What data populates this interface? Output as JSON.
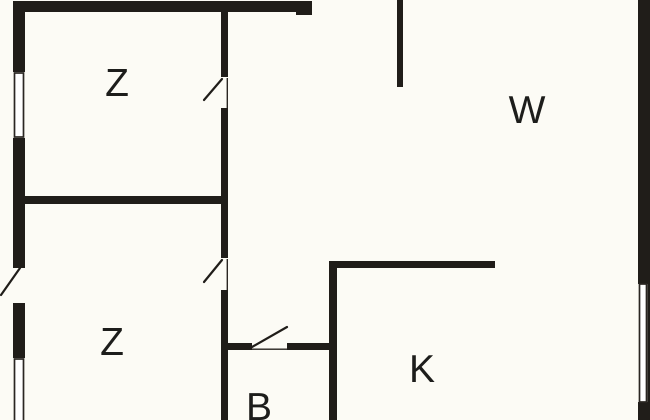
{
  "title": "Floor plan",
  "canvas": {
    "width": 650,
    "height": 420,
    "background": "#fcfbf5",
    "wall_color": "#201d19",
    "line_color": "#2a2622",
    "window_fill": "#ffffff",
    "label_color": "#1d1d1b"
  },
  "rooms": [
    {
      "label": "Z",
      "x": 117,
      "y": 96
    },
    {
      "label": "Z",
      "x": 112,
      "y": 355
    },
    {
      "label": "W",
      "x": 527,
      "y": 123
    },
    {
      "label": "K",
      "x": 422,
      "y": 382
    },
    {
      "label": "B",
      "x": 259,
      "y": 420
    }
  ],
  "plan": {
    "walls": [
      {
        "x": 13,
        "y": 1,
        "w": 299,
        "h": 11
      },
      {
        "x": 296,
        "y": 11,
        "w": 16,
        "h": 4
      },
      {
        "x": 13,
        "y": 1,
        "w": 12,
        "h": 71
      },
      {
        "x": 13,
        "y": 138,
        "w": 12,
        "h": 130
      },
      {
        "x": 13,
        "y": 303,
        "w": 12,
        "h": 55
      },
      {
        "x": 13,
        "y": 196,
        "w": 215,
        "h": 8
      },
      {
        "x": 221,
        "y": 11,
        "w": 7,
        "h": 66
      },
      {
        "x": 221,
        "y": 108,
        "w": 7,
        "h": 150
      },
      {
        "x": 221,
        "y": 290,
        "w": 7,
        "h": 130
      },
      {
        "x": 397,
        "y": 0,
        "w": 6,
        "h": 87
      },
      {
        "x": 638,
        "y": 0,
        "w": 12,
        "h": 284
      },
      {
        "x": 638,
        "y": 402,
        "w": 12,
        "h": 18
      },
      {
        "x": 329,
        "y": 261,
        "w": 166,
        "h": 7
      },
      {
        "x": 329,
        "y": 261,
        "w": 8,
        "h": 159
      },
      {
        "x": 228,
        "y": 343,
        "w": 24,
        "h": 7
      },
      {
        "x": 287,
        "y": 343,
        "w": 42,
        "h": 7
      },
      {
        "x": 647.5,
        "y": 284,
        "w": 2.5,
        "h": 118
      }
    ],
    "windows": [
      {
        "x": 14.5,
        "y": 73,
        "w": 9,
        "h": 64
      },
      {
        "x": 14.5,
        "y": 359,
        "w": 9,
        "h": 63
      },
      {
        "x": 639.5,
        "y": 284,
        "w": 7,
        "h": 118
      }
    ],
    "door_swings": [
      {
        "x1": 20,
        "y1": 268,
        "x2": 1,
        "y2": 295
      },
      {
        "x1": 222,
        "y1": 79,
        "x2": 204,
        "y2": 100
      },
      {
        "x1": 222,
        "y1": 260,
        "x2": 204,
        "y2": 282
      },
      {
        "x1": 252,
        "y1": 347,
        "x2": 287,
        "y2": 327
      }
    ],
    "thin_lines": [
      {
        "x": 226.6,
        "y": 78,
        "w": 1.4,
        "h": 30
      },
      {
        "x": 226.6,
        "y": 259,
        "w": 1.4,
        "h": 31
      },
      {
        "x": 252,
        "y": 348.5,
        "w": 35,
        "h": 1.4
      }
    ]
  }
}
